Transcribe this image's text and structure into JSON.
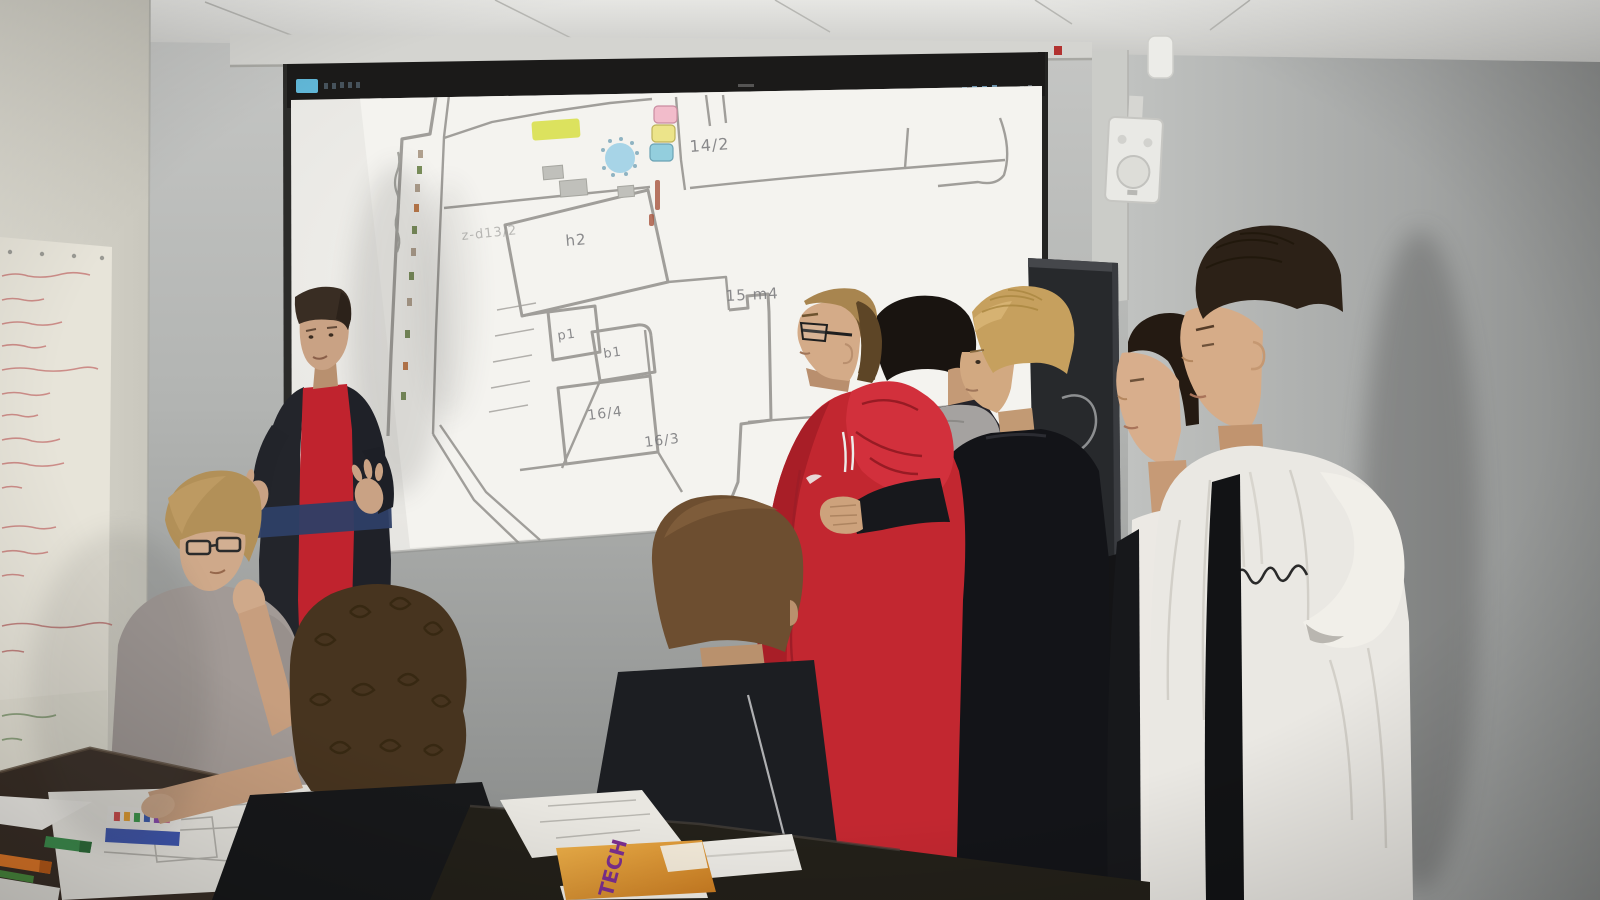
{
  "scene": {
    "setting": "classroom presentation",
    "description": "A student presents a projected cadastral site plan to classmates standing and sitting around tables"
  },
  "projection": {
    "map": {
      "labels": {
        "parcel_14_2": "14/2",
        "area_h2": "h2",
        "area_15_m4": "15 m4",
        "parcel_p1": "p1",
        "parcel_b1": "b1",
        "parcel_16_4": "16/4",
        "parcel_16_3": "16/3",
        "strip_label": "z-d13/2"
      },
      "colors": {
        "highlight_yellow": "#d9e04e",
        "pond_blue": "#9fd0e6",
        "marker_pink": "#f2bccb",
        "marker_yellow": "#ece48a",
        "marker_blue": "#93cedd",
        "parcel_line_gray": "#a09e9a"
      }
    }
  },
  "handout": {
    "brochure_text": "TECH",
    "brochure_color": "#e09a33",
    "brochure_text_color": "#7b2f8e"
  },
  "figures": [
    {
      "id": "presenter",
      "clothing": "dark jacket with navy stripe over red t-shirt"
    },
    {
      "id": "student-seated-glasses",
      "clothing": "gray t-shirt"
    },
    {
      "id": "student-curly-hair",
      "clothing": "black shirt"
    },
    {
      "id": "student-center-back",
      "clothing": "dark zip jacket"
    },
    {
      "id": "student-red-hoodie",
      "clothing": "red hoodie, glasses"
    },
    {
      "id": "student-gray-hood",
      "clothing": "dark top with gray hood"
    },
    {
      "id": "student-blond-black",
      "clothing": "black sweatshirt"
    },
    {
      "id": "student-white-shirt",
      "clothing": "white shirt under black jacket"
    },
    {
      "id": "student-white-hoodie",
      "clothing": "white hoodie with script logo"
    }
  ],
  "room": {
    "furniture": [
      "projector-screen",
      "flipchart-paper",
      "wall-speaker",
      "wall-sensor",
      "tv-display",
      "work-tables"
    ],
    "props": [
      "site-plan-papers",
      "marker-box",
      "green-marker",
      "orange-marker",
      "rolled-paper",
      "orange-brochure"
    ]
  }
}
